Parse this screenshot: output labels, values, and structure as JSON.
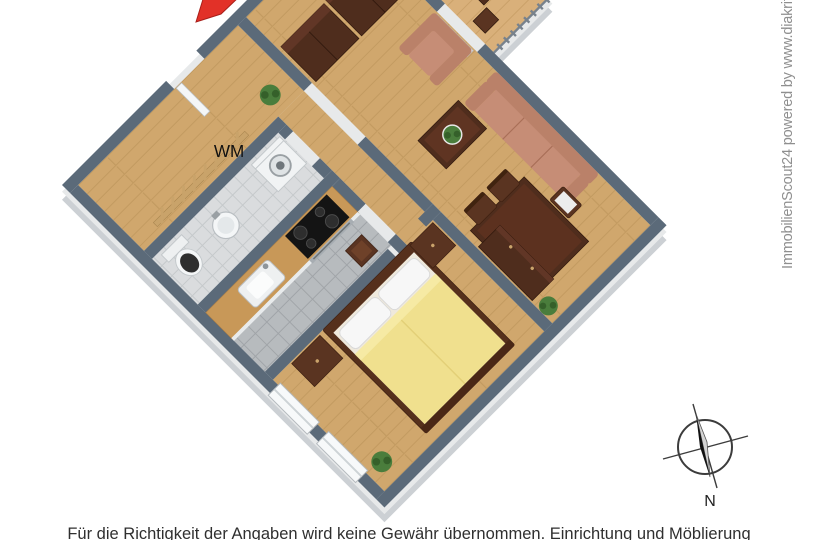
{
  "page": {
    "width": 818,
    "height": 540,
    "background": "#ffffff"
  },
  "watermark": {
    "text": "ImmobilienScout24 powered by www.diakrit.c",
    "color": "#8f8f8f"
  },
  "disclaimer": {
    "text": "Für die Richtigkeit der Angaben wird keine Gewähr übernommen. Einrichtung und Möblierung",
    "color": "#2f2f2f"
  },
  "floorplan": {
    "type": "3d-floor-plan-top-view",
    "rotation_deg": -45,
    "labels": {
      "washing_machine": "WM"
    },
    "compass": {
      "label": "N"
    },
    "rooms": [
      "hall",
      "bathroom",
      "kitchen",
      "bedroom",
      "living-room",
      "balcony"
    ],
    "furniture": [
      "coat-rack",
      "washing-machine",
      "toilet",
      "basin",
      "kitchen-counter",
      "sink",
      "stove",
      "stool",
      "double-bed",
      "nightstand-left",
      "nightstand-right",
      "wardrobe",
      "wardrobe-2",
      "armchair",
      "sofa",
      "coffee-table",
      "dining-table",
      "dining-chairs",
      "sideboard",
      "potted-plant",
      "balcony-furniture"
    ],
    "colors": {
      "entrance_arrow": "#e23128",
      "wall_top": "#5b6a79",
      "wall_outer_face": "#ccd0d4",
      "floor_wood": "#d0a76d",
      "floor_tile_kitchen": "#b7bbbe",
      "floor_tile_bath": "#dadcde",
      "bed_duvet": "#f0e08e",
      "upholstery_salmon": "#c68d76",
      "furniture_wood_dark": "#4f2d1d",
      "counter_wood": "#c89858",
      "plant_green": "#4a7d3c"
    }
  }
}
